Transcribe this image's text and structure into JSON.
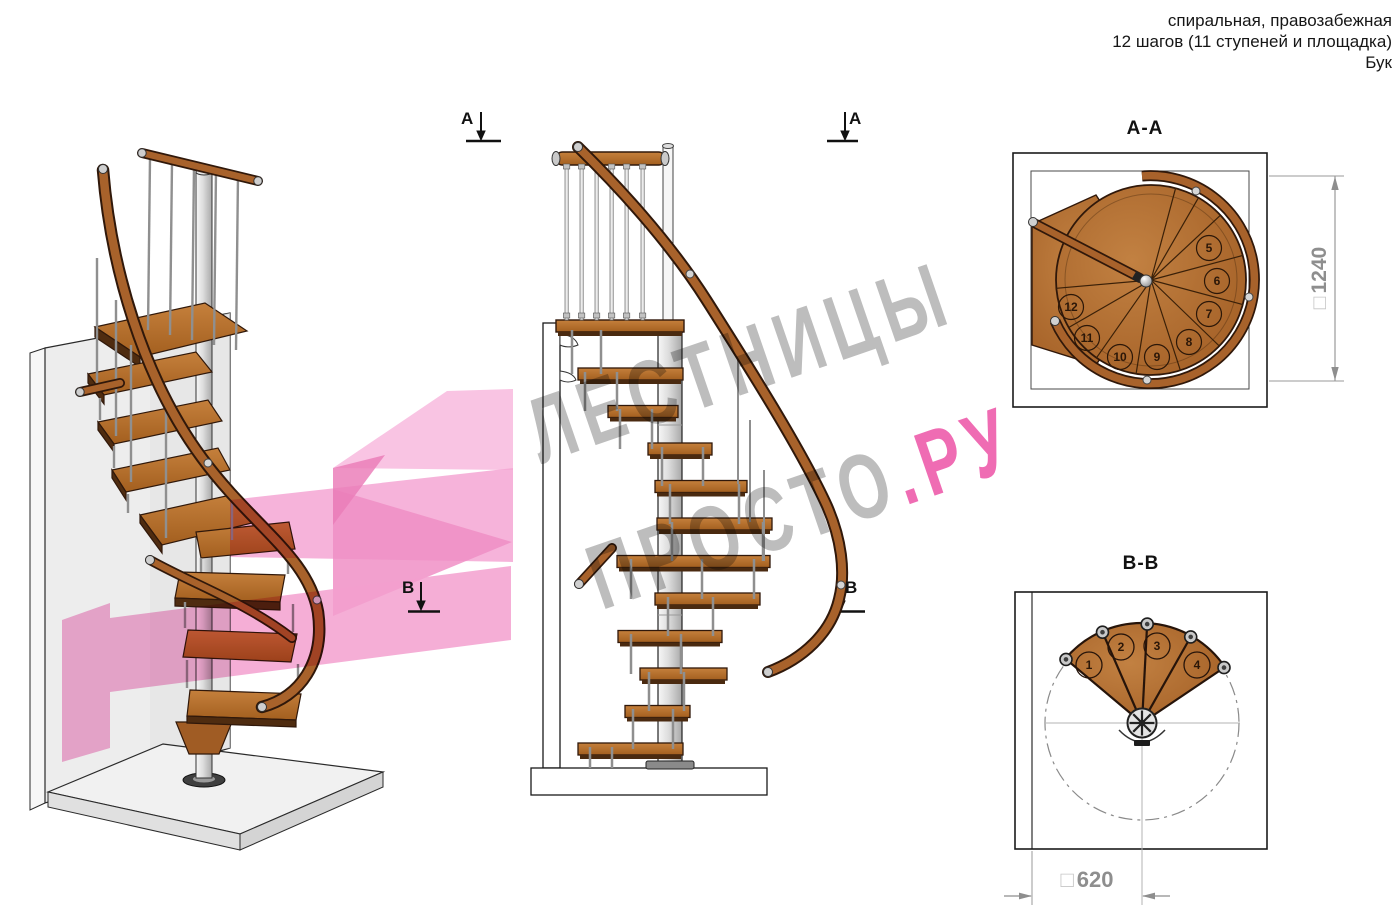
{
  "header": {
    "line1": "спиральная, правозабежная",
    "line2": "12 шагов (11 ступеней и площадка)",
    "line3": "Бук"
  },
  "watermark": {
    "line1": "ЛЕСТНИЦЫ",
    "line2_main": "ПРОСТО",
    "line2_accent": ".РУ",
    "gray": "#bdbdbd",
    "pink": "#ef6cb3"
  },
  "sections": {
    "aa": {
      "title": "A-A",
      "marker": "A",
      "dimension_prefix": "□",
      "dimension_value": "1240",
      "steps": [
        "5",
        "6",
        "7",
        "8",
        "9",
        "10",
        "11",
        "12"
      ]
    },
    "bb": {
      "title": "B-B",
      "marker": "B",
      "dimension_prefix": "□",
      "dimension_value": "620",
      "steps": [
        "1",
        "2",
        "3",
        "4"
      ]
    }
  },
  "colors": {
    "wood": "#b06c2e",
    "wood_outline": "#30180a",
    "metal": "#c9c9c9",
    "dimension_gray": "#8e8e8e",
    "watermark_gray": "#bdbdbd",
    "watermark_pink": "#ef6cb3",
    "overlay_pink": "#f5a6d3"
  }
}
